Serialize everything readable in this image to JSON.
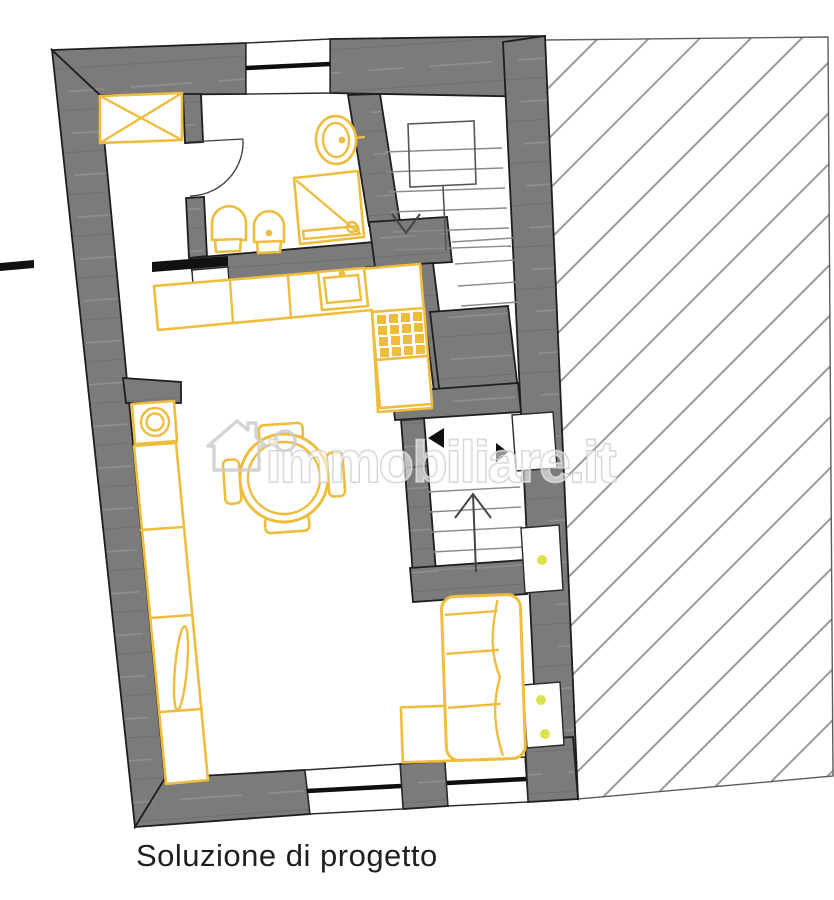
{
  "caption": {
    "text": "Soluzione di progetto"
  },
  "watermark": {
    "text": "immobiliare.it",
    "icon": "house-icon"
  },
  "colors": {
    "background": "#ffffff",
    "wall": "#7b7b7b",
    "outline": "#1e1e1e",
    "furniture": "#eebd3e",
    "hatch": "#9a9a9a",
    "accent_dot": "#dde24f",
    "watermark": "#cdcdcd",
    "caption_text": "#1f1f1f"
  }
}
